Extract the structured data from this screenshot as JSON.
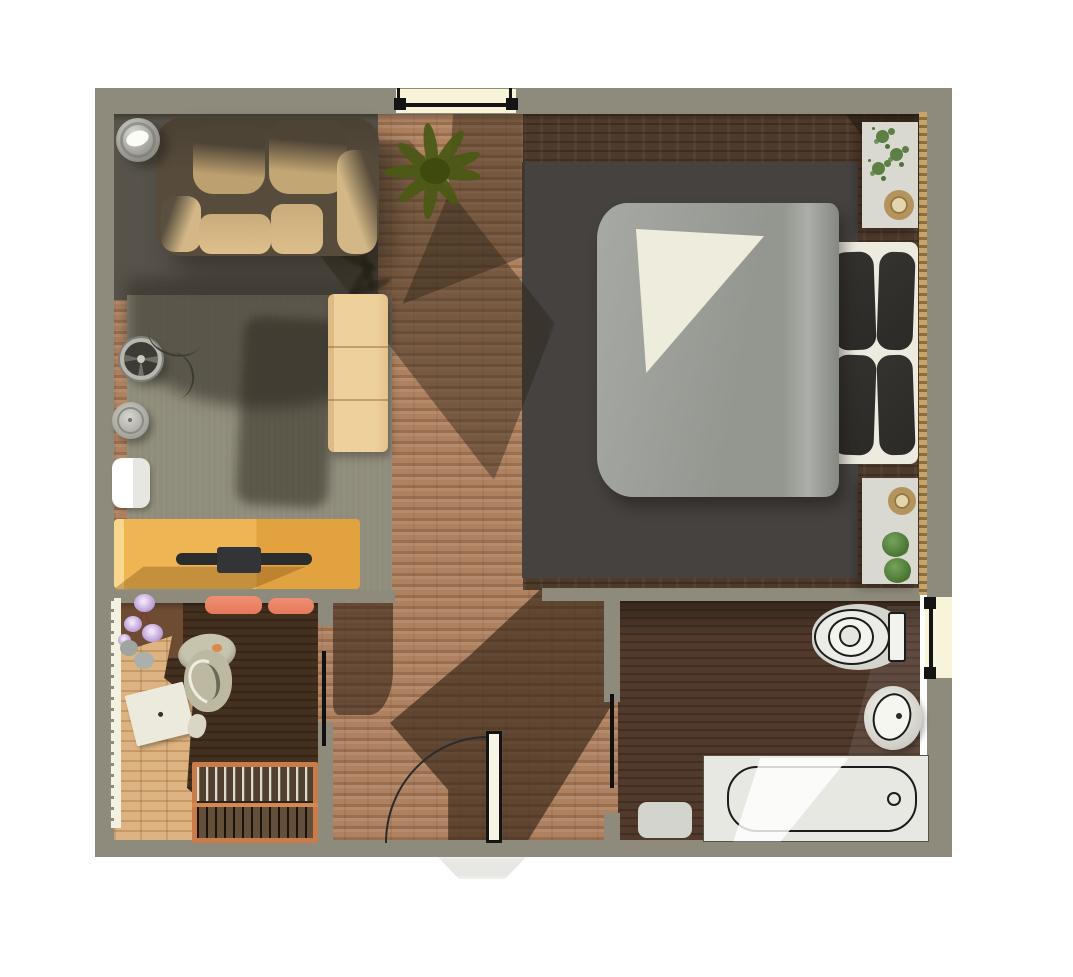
{
  "scene": {
    "name": "apartment-floor-plan-3d-render",
    "view": "top-down orthographic render",
    "background": "#ffffff",
    "canvas": {
      "width": 1073,
      "height": 977
    },
    "visible_text": []
  },
  "palette": {
    "wall": "#8e8b7c",
    "brick_floor": "#ae8160",
    "living_floor": "#8f8c7b",
    "living_rug": "#57524a",
    "bedroom_rug": "#454240",
    "dark_wood": "#4e3a2b",
    "nursery_wood": "#44301f",
    "nursery_light_wood": "#dcb381",
    "nursery_mid_wood": "#6e4c34",
    "window_glass": "#f8f4da",
    "frame_black": "#141414",
    "gold_trim": "#c9a468",
    "desk": "#efb553",
    "cabinet": "#eed09c",
    "sofa_body": "#574c3c",
    "sofa_cushion": "#d3b786",
    "duvet": "#9da099",
    "sheet": "#eeecdc",
    "pillow": "#2c2a27",
    "bed_frame": "#edebe0",
    "nightstand": "#d9d9d1",
    "fixture": "#e8e8e2",
    "outline": "#1c1c1c",
    "crib_frame": "#c87c49",
    "cushion_orange": "#e5795b",
    "plant_dark": "#4b5914",
    "plant_light": "#5b7f44",
    "flower": "#c4abdd",
    "chair": "#bdb9a1",
    "lamp": "#c9c9c2",
    "paper": "#eceadd"
  },
  "rooms": [
    {
      "id": "living-area",
      "floor": "gray-green carpet over brick",
      "items": [
        "sofa",
        "floor-lamp",
        "potted-plant",
        "sideboard",
        "desk-with-monitor",
        "table-fan",
        "speaker",
        "small-bench"
      ]
    },
    {
      "id": "bedroom",
      "floor": "dark wood with dark area rug",
      "items": [
        "double-bed",
        "nightstand-top",
        "nightstand-bottom",
        "gold-curtain-trim"
      ]
    },
    {
      "id": "nursery-office",
      "floor": "light and dark wood",
      "items": [
        "office-chair",
        "baby-crib",
        "flower-bouquet",
        "paper-sheet",
        "bench-cushions",
        "baseboard-heater"
      ]
    },
    {
      "id": "bathroom",
      "floor": "dark brick",
      "items": [
        "toilet",
        "washbasin",
        "bathtub",
        "bath-mat"
      ]
    },
    {
      "id": "hallway",
      "floor": "brick with cast shadows",
      "items": []
    }
  ],
  "furniture": [
    {
      "id": "sofa",
      "label": "two-seat brown sofa with tan cushions"
    },
    {
      "id": "floor-lamp",
      "label": "round floor lamp"
    },
    {
      "id": "potted-plant",
      "label": "large dark green plant"
    },
    {
      "id": "sideboard",
      "label": "tan three-section cabinet"
    },
    {
      "id": "desk",
      "label": "golden desk with dark monitor"
    },
    {
      "id": "table-fan",
      "label": "round fan"
    },
    {
      "id": "speaker",
      "label": "round speaker"
    },
    {
      "id": "small-bench",
      "label": "small white bench"
    },
    {
      "id": "double-bed",
      "label": "double bed, gray duvet, white sheet, four dark pillows"
    },
    {
      "id": "nightstand-top",
      "label": "white nightstand with plant and gold bowl"
    },
    {
      "id": "nightstand-bottom",
      "label": "white nightstand with gold bowl and two plants"
    },
    {
      "id": "toilet",
      "label": "toilet"
    },
    {
      "id": "washbasin",
      "label": "round washbasin"
    },
    {
      "id": "bathtub",
      "label": "bathtub with drain"
    },
    {
      "id": "bath-mat",
      "label": "gray bath mat"
    },
    {
      "id": "office-chair",
      "label": "swivel office chair"
    },
    {
      "id": "baby-crib",
      "label": "orange baby crib with slats"
    },
    {
      "id": "bench-cushions",
      "label": "two orange cushions"
    },
    {
      "id": "flower-bouquet",
      "label": "purple flowers"
    },
    {
      "id": "paper-sheet",
      "label": "white sheet of paper"
    }
  ],
  "openings": {
    "windows": [
      {
        "id": "top-window",
        "wall": "north",
        "symbol": "black frame on cream glass"
      },
      {
        "id": "right-window",
        "wall": "east",
        "symbol": "black frame on cream glass"
      }
    ],
    "doors": [
      {
        "id": "entrance-door",
        "type": "hinged",
        "state": "open with swing arc"
      },
      {
        "id": "nursery-door",
        "type": "leaf",
        "state": "open"
      },
      {
        "id": "bathroom-door",
        "type": "leaf",
        "state": "open"
      }
    ]
  }
}
